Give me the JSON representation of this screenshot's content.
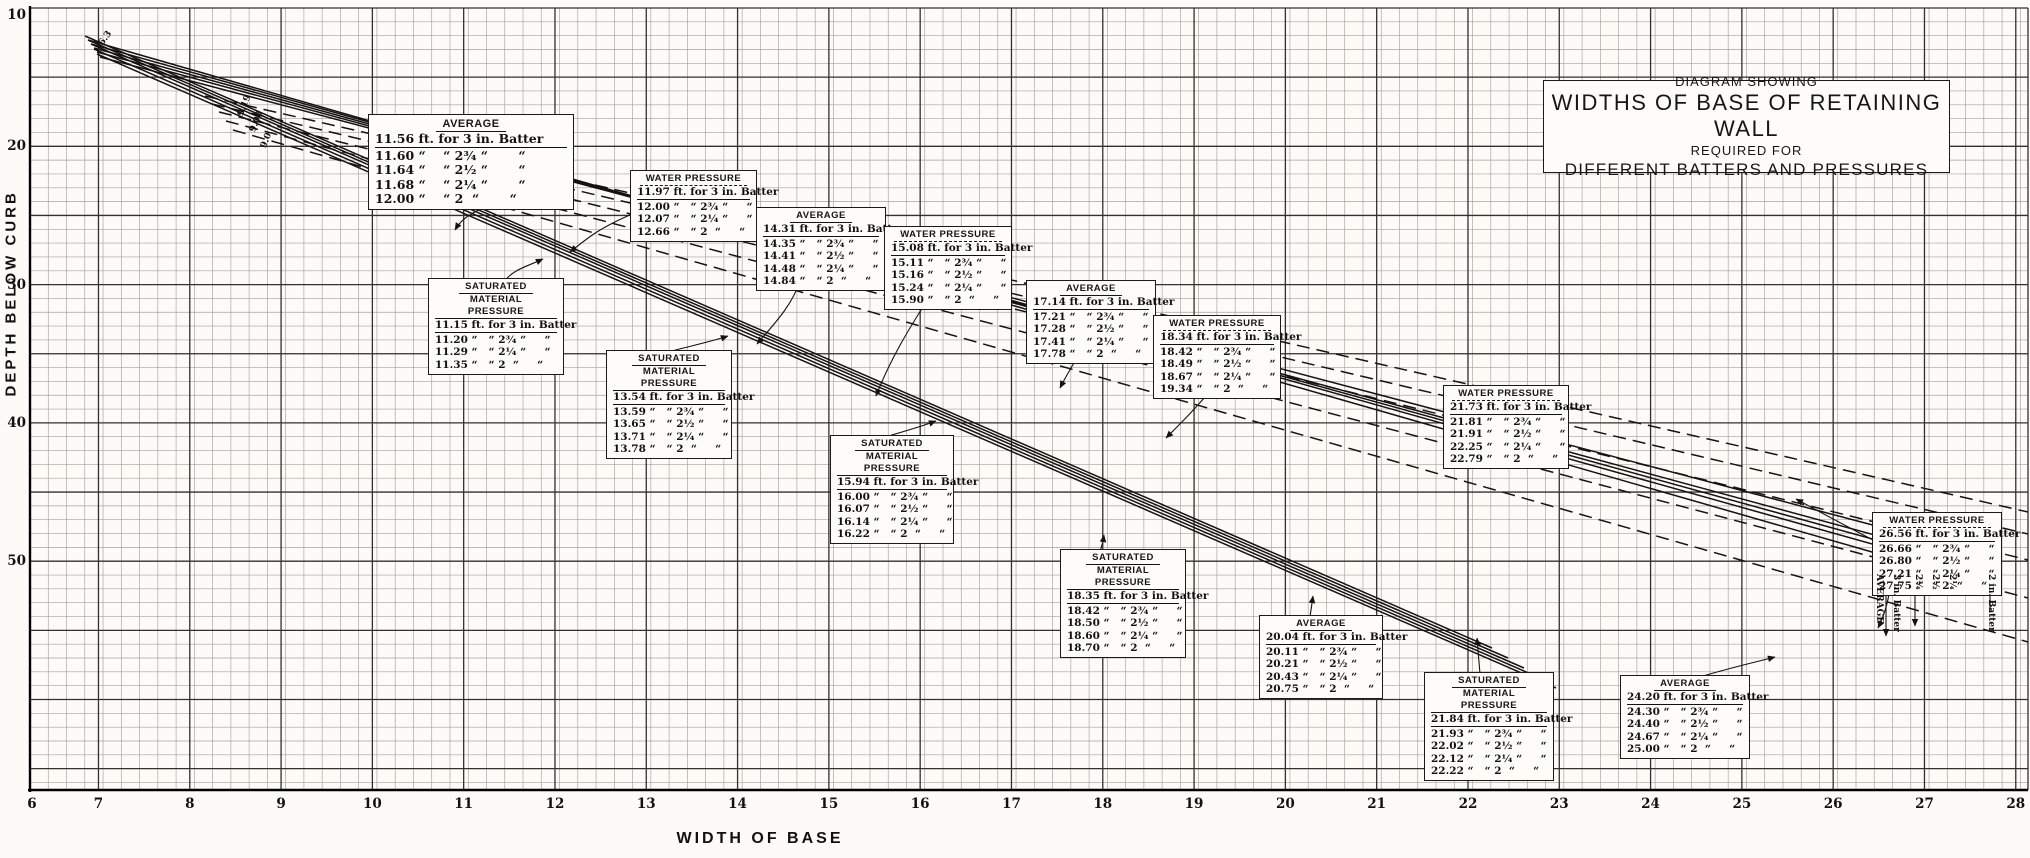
{
  "title_block": {
    "line1": "DIAGRAM SHOWING",
    "line2": "WIDTHS OF BASE OF RETAINING WALL",
    "line3": "REQUIRED FOR",
    "line4": "DIFFERENT BATTERS AND PRESSURES"
  },
  "axes": {
    "y_label": "DEPTH BELOW CURB",
    "x_label": "WIDTH OF BASE"
  },
  "chart_data": {
    "type": "line",
    "title": "DIAGRAM SHOWING WIDTHS OF BASE OF RETAINING WALL REQUIRED FOR DIFFERENT BATTERS AND PRESSURES",
    "xlabel": "WIDTH OF BASE",
    "ylabel": "DEPTH BELOW CURB",
    "x_ticks": [
      6,
      7,
      8,
      9,
      10,
      11,
      12,
      13,
      14,
      15,
      16,
      17,
      18,
      19,
      20,
      21,
      22,
      23,
      24,
      25,
      26,
      27,
      28
    ],
    "y_ticks": [
      10,
      20,
      30,
      40,
      50
    ],
    "xlim": [
      6,
      28
    ],
    "ylim": [
      10,
      55
    ],
    "grid": "fine 0.2 ft squares, heavy rule each 1 ft width and 5 ft depth",
    "batters": [
      "3 in.",
      "2¾ in.",
      "2½ in.",
      "2¼ in.",
      "2 in."
    ],
    "line_styles": {
      "AVERAGE": "solid",
      "WATER PRESSURE": "dashed",
      "SATURATED MATERIAL PRESSURE": "solid"
    },
    "stations": [
      {
        "pressure": "AVERAGE",
        "widths_ft": [
          11.56,
          11.6,
          11.64,
          11.68,
          12.0
        ]
      },
      {
        "pressure": "WATER PRESSURE",
        "widths_ft": [
          11.97,
          12.0,
          12.07,
          12.66
        ]
      },
      {
        "pressure": "SATURATED MATERIAL PRESSURE",
        "widths_ft": [
          11.15,
          11.2,
          11.29,
          11.35
        ]
      },
      {
        "pressure": "AVERAGE",
        "widths_ft": [
          14.31,
          14.35,
          14.41,
          14.48,
          14.84
        ]
      },
      {
        "pressure": "WATER PRESSURE",
        "widths_ft": [
          15.08,
          15.11,
          15.16,
          15.24,
          15.9
        ]
      },
      {
        "pressure": "SATURATED MATERIAL PRESSURE",
        "widths_ft": [
          13.54,
          13.59,
          13.65,
          13.71,
          13.78
        ]
      },
      {
        "pressure": "AVERAGE",
        "widths_ft": [
          17.14,
          17.21,
          17.28,
          17.41,
          17.78
        ]
      },
      {
        "pressure": "WATER PRESSURE",
        "widths_ft": [
          18.34,
          18.42,
          18.49,
          18.67,
          19.34
        ]
      },
      {
        "pressure": "SATURATED MATERIAL PRESSURE",
        "widths_ft": [
          15.94,
          16.0,
          16.07,
          16.14,
          16.22
        ]
      },
      {
        "pressure": "WATER PRESSURE",
        "widths_ft": [
          21.73,
          21.81,
          21.91,
          22.25,
          22.79
        ]
      },
      {
        "pressure": "SATURATED MATERIAL PRESSURE",
        "widths_ft": [
          18.35,
          18.42,
          18.5,
          18.6,
          18.7
        ]
      },
      {
        "pressure": "AVERAGE",
        "widths_ft": [
          20.04,
          20.11,
          20.21,
          20.43,
          20.75
        ]
      },
      {
        "pressure": "SATURATED MATERIAL PRESSURE",
        "widths_ft": [
          21.84,
          21.93,
          22.02,
          22.12,
          22.22
        ]
      },
      {
        "pressure": "AVERAGE",
        "widths_ft": [
          24.2,
          24.3,
          24.4,
          24.67,
          25.0
        ]
      },
      {
        "pressure": "WATER PRESSURE",
        "widths_ft": [
          26.56,
          26.66,
          26.8,
          27.21,
          27.75
        ]
      }
    ],
    "pixel_lines": [
      {
        "family": "saturated",
        "batter": "3 in.",
        "dash": false,
        "x1": 85,
        "y1": 36,
        "x2": 1492,
        "y2": 648
      },
      {
        "family": "saturated",
        "batter": "2¾ in.",
        "dash": false,
        "x1": 88,
        "y1": 40,
        "x2": 1508,
        "y2": 658
      },
      {
        "family": "saturated",
        "batter": "2½ in.",
        "dash": false,
        "x1": 91,
        "y1": 44,
        "x2": 1524,
        "y2": 668
      },
      {
        "family": "saturated",
        "batter": "2¼ in.",
        "dash": false,
        "x1": 94,
        "y1": 49,
        "x2": 1540,
        "y2": 678
      },
      {
        "family": "saturated",
        "batter": "2 in.",
        "dash": false,
        "x1": 97,
        "y1": 54,
        "x2": 1556,
        "y2": 688
      },
      {
        "family": "average",
        "batter": "3 in.",
        "dash": false,
        "x1": 88,
        "y1": 40,
        "x2": 1886,
        "y2": 556
      },
      {
        "family": "average",
        "batter": "2¾ in.",
        "dash": false,
        "x1": 91,
        "y1": 44,
        "x2": 1915,
        "y2": 556
      },
      {
        "family": "average",
        "batter": "2½ in.",
        "dash": false,
        "x1": 94,
        "y1": 48,
        "x2": 1934,
        "y2": 556
      },
      {
        "family": "average",
        "batter": "2¼ in.",
        "dash": false,
        "x1": 97,
        "y1": 52,
        "x2": 1952,
        "y2": 556
      },
      {
        "family": "average",
        "batter": "2 in.",
        "dash": false,
        "x1": 100,
        "y1": 57,
        "x2": 1990,
        "y2": 556
      },
      {
        "family": "water",
        "batter": "3 in.",
        "dash": true,
        "x1": 205,
        "y1": 96,
        "x2": 2028,
        "y2": 512
      },
      {
        "family": "water",
        "batter": "2¾ in.",
        "dash": true,
        "x1": 212,
        "y1": 104,
        "x2": 2028,
        "y2": 534
      },
      {
        "family": "water",
        "batter": "2½ in.",
        "dash": true,
        "x1": 219,
        "y1": 112,
        "x2": 2028,
        "y2": 560
      },
      {
        "family": "water",
        "batter": "2¼ in.",
        "dash": true,
        "x1": 226,
        "y1": 121,
        "x2": 2028,
        "y2": 598
      },
      {
        "family": "water",
        "batter": "2 in.",
        "dash": true,
        "x1": 233,
        "y1": 130,
        "x2": 2028,
        "y2": 642
      }
    ],
    "leaders": [
      {
        "d": "M500,190 C486,214 468,208 455,230"
      },
      {
        "d": "M632,214 C600,228 590,236 570,252"
      },
      {
        "d": "M505,281 C512,270 528,266 543,259"
      },
      {
        "d": "M800,281 C792,305 776,322 757,344"
      },
      {
        "d": "M930,296 C908,330 890,360 876,396"
      },
      {
        "d": "M668,352 C690,346 710,342 728,336"
      },
      {
        "d": "M1080,353 C1072,366 1066,376 1060,388"
      },
      {
        "d": "M1210,391 C1196,408 1182,422 1166,438"
      },
      {
        "d": "M885,437 C902,432 920,427 936,421"
      },
      {
        "d": "M1100,551 C1102,546 1103,542 1104,535"
      },
      {
        "d": "M1480,674 C1479,662 1478,650 1477,638"
      },
      {
        "d": "M1310,617 C1311,610 1312,603 1313,596"
      },
      {
        "d": "M1700,677 C1722,670 1748,664 1775,657"
      },
      {
        "d": "M1890,588 C1888,602 1884,616 1878,628"
      },
      {
        "d": "M1873,540 C1846,526 1820,512 1796,499"
      },
      {
        "d": "M1886,558 L1886,636"
      },
      {
        "d": "M1915,558 L1915,626"
      },
      {
        "d": "M1990,558 L1990,612",
        "noarrow": true
      }
    ],
    "colors": {
      "paper": "#fcfbf8",
      "grid_minor": "#a6a29a",
      "grid_major": "#33302b",
      "ink": "#151310"
    }
  },
  "boxes": [
    {
      "id": "avg-1156",
      "kind": "average",
      "big": true,
      "x": 368,
      "y": 114,
      "w": 206,
      "title": [
        "AVERAGE"
      ],
      "rows": [
        "11.56 ft. for 3 in. Batter",
        "11.60 “    “ 2¾ “       “",
        "11.64 “    “ 2½ “       “",
        "11.68 “    “ 2¼ “       “",
        "12.00 “    “ 2  “       “"
      ]
    },
    {
      "id": "wat-1197",
      "kind": "water",
      "x": 630,
      "y": 170,
      "w": 127,
      "title": [
        "WATER PRESSURE"
      ],
      "rows": [
        "11.97 ft. for 3 in. Batter",
        "12.00 “   “ 2¾ “     “",
        "12.07 “   “ 2¼ “     “",
        "12.66 “   “ 2  “     “"
      ]
    },
    {
      "id": "sat-1115",
      "kind": "saturated",
      "x": 428,
      "y": 278,
      "w": 136,
      "title": [
        "SATURATED",
        "MATERIAL PRESSURE"
      ],
      "rows": [
        "11.15 ft. for 3 in. Batter",
        "11.20 “   “ 2¾ “     “",
        "11.29 “   “ 2¼ “     “",
        "11.35 “   “ 2  “     “"
      ]
    },
    {
      "id": "avg-1431",
      "kind": "average",
      "x": 756,
      "y": 207,
      "w": 130,
      "title": [
        "AVERAGE"
      ],
      "rows": [
        "14.31 ft. for 3 in. Batter",
        "14.35 “   “ 2¾ “     “",
        "14.41 “   “ 2½ “     “",
        "14.48 “   “ 2¼ “     “",
        "14.84 “   “ 2  “     “"
      ]
    },
    {
      "id": "wat-1508",
      "kind": "water",
      "x": 884,
      "y": 226,
      "w": 128,
      "title": [
        "WATER PRESSURE"
      ],
      "rows": [
        "15.08 ft. for 3 in. Batter",
        "15.11 “   “ 2¾ “     “",
        "15.16 “   “ 2½ “     “",
        "15.24 “   “ 2¼ “     “",
        "15.90 “   “ 2  “     “"
      ]
    },
    {
      "id": "sat-1354",
      "kind": "saturated",
      "x": 606,
      "y": 350,
      "w": 126,
      "title": [
        "SATURATED",
        "MATERIAL PRESSURE"
      ],
      "rows": [
        "13.54 ft. for 3 in. Batter",
        "13.59 “   “ 2¾ “     “",
        "13.65 “   “ 2½ “     “",
        "13.71 “   “ 2¼ “     “",
        "13.78 “   “ 2  “     “"
      ]
    },
    {
      "id": "avg-1714",
      "kind": "average",
      "x": 1026,
      "y": 280,
      "w": 130,
      "title": [
        "AVERAGE"
      ],
      "rows": [
        "17.14 ft. for 3 in. Batter",
        "17.21 “   “ 2¾ “     “",
        "17.28 “   “ 2½ “     “",
        "17.41 “   “ 2¼ “     “",
        "17.78 “   “ 2  “     “"
      ]
    },
    {
      "id": "wat-1834",
      "kind": "water",
      "x": 1153,
      "y": 315,
      "w": 128,
      "title": [
        "WATER PRESSURE"
      ],
      "rows": [
        "18.34 ft. for 3 in. Batter",
        "18.42 “   “ 2¾ “     “",
        "18.49 “   “ 2½ “     “",
        "18.67 “   “ 2¼ “     “",
        "19.34 “   “ 2  “     “"
      ]
    },
    {
      "id": "sat-1594",
      "kind": "saturated",
      "x": 830,
      "y": 435,
      "w": 124,
      "title": [
        "SATURATED",
        "MATERIAL PRESSURE"
      ],
      "rows": [
        "15.94 ft. for 3 in. Batter",
        "16.00 “   “ 2¾ “     “",
        "16.07 “   “ 2½ “     “",
        "16.14 “   “ 2¼ “     “",
        "16.22 “   “ 2  “     “"
      ]
    },
    {
      "id": "wat-2173",
      "kind": "water",
      "x": 1443,
      "y": 385,
      "w": 126,
      "title": [
        "WATER PRESSURE"
      ],
      "rows": [
        "21.73 ft. for 3 in. Batter",
        "21.81 “   “ 2¾ “     “",
        "21.91 “   “ 2½ “     “",
        "22.25 “   “ 2¼ “     “",
        "22.79 “   “ 2  “     “"
      ]
    },
    {
      "id": "sat-1835",
      "kind": "saturated",
      "x": 1060,
      "y": 549,
      "w": 126,
      "title": [
        "SATURATED",
        "MATERIAL PRESSURE"
      ],
      "rows": [
        "18.35 ft. for 3 in. Batter",
        "18.42 “   “ 2¾ “     “",
        "18.50 “   “ 2½ “     “",
        "18.60 “   “ 2¼ “     “",
        "18.70 “   “ 2  “     “"
      ]
    },
    {
      "id": "avg-2004",
      "kind": "average",
      "x": 1259,
      "y": 615,
      "w": 124,
      "title": [
        "AVERAGE"
      ],
      "rows": [
        "20.04 ft. for 3 in. Batter",
        "20.11 “   “ 2¾ “     “",
        "20.21 “   “ 2½ “     “",
        "20.43 “   “ 2¼ “     “",
        "20.75 “   “ 2  “     “"
      ]
    },
    {
      "id": "sat-2184",
      "kind": "saturated",
      "x": 1424,
      "y": 672,
      "w": 130,
      "title": [
        "SATURATED",
        "MATERIAL PRESSURE"
      ],
      "rows": [
        "21.84 ft. for 3 in. Batter",
        "21.93 “   “ 2¾ “     “",
        "22.02 “   “ 2½ “     “",
        "22.12 “   “ 2¼ “     “",
        "22.22 “   “ 2  “     “"
      ]
    },
    {
      "id": "avg-2420",
      "kind": "average",
      "x": 1620,
      "y": 675,
      "w": 130,
      "title": [
        "AVERAGE"
      ],
      "rows": [
        "24.20 ft. for 3 in. Batter",
        "24.30 “   “ 2¾ “     “",
        "24.40 “   “ 2½ “     “",
        "24.67 “   “ 2¼ “     “",
        "25.00 “   “ 2  “     “"
      ]
    },
    {
      "id": "wat-2656",
      "kind": "water",
      "x": 1872,
      "y": 512,
      "w": 130,
      "title": [
        "WATER PRESSURE"
      ],
      "rows": [
        "26.56 ft. for 3 in. Batter",
        "26.66 “   “ 2¾ “     “",
        "26.80 “   “ 2½ “     “",
        "27.21 “   “ 2¼ “     “",
        "27.75 “   “ 2  “     “"
      ]
    }
  ],
  "end_labels": [
    {
      "text": "AVERAGE",
      "x": 1884,
      "y": 574
    },
    {
      "text": "3 in. Batter",
      "x": 1901,
      "y": 574
    },
    {
      "text": "2¾",
      "x": 1923,
      "y": 574
    },
    {
      "text": "2½",
      "x": 1940,
      "y": 574
    },
    {
      "text": "2¼",
      "x": 1957,
      "y": 574
    },
    {
      "text": "2 in. Batter",
      "x": 1996,
      "y": 574
    }
  ],
  "start_labels": [
    {
      "text": "6.3",
      "x": 97,
      "y": 42,
      "rot": -55
    },
    {
      "text": "9.19",
      "x": 236,
      "y": 114,
      "rot": -68
    },
    {
      "text": "9.00",
      "x": 248,
      "y": 130,
      "rot": -68
    },
    {
      "text": "9.0",
      "x": 259,
      "y": 146,
      "rot": -68
    }
  ]
}
